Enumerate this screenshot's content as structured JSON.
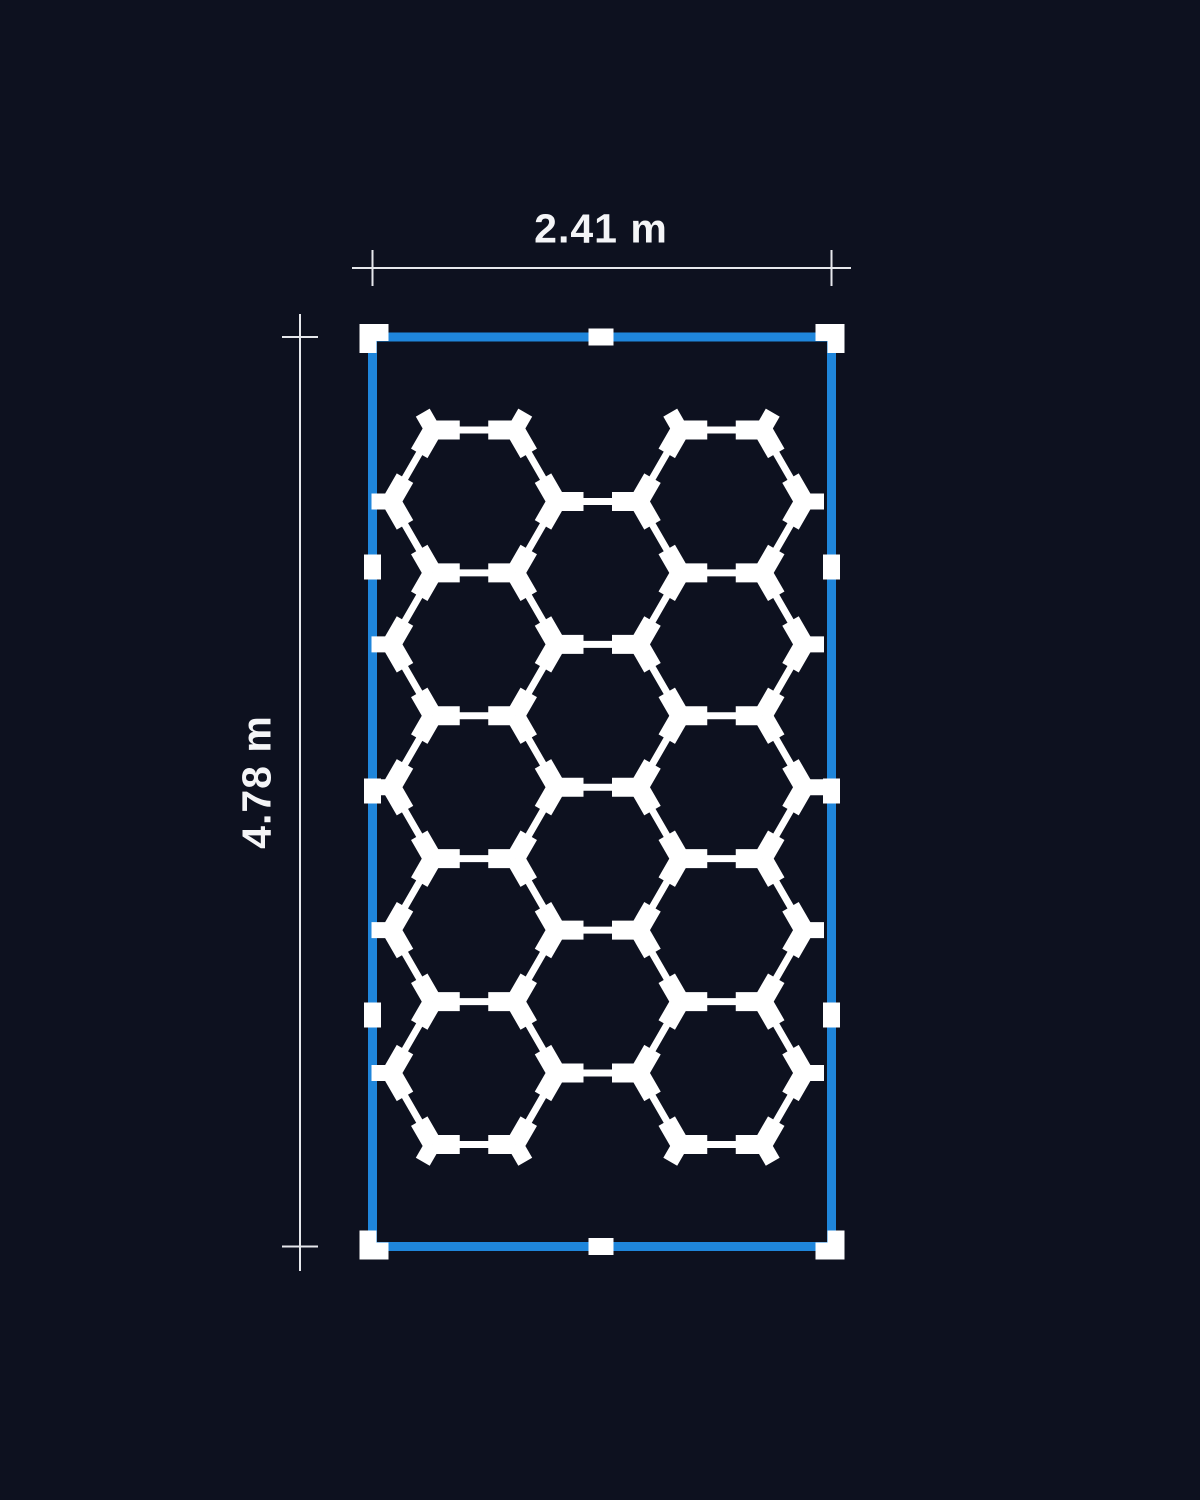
{
  "labels": {
    "width": "2.41 m",
    "height": "4.78 m"
  },
  "colors": {
    "background": "#0d111f",
    "frame_blue": "#1f86db",
    "grid_white": "#ffffff",
    "dimension_line": "#e6e8ec",
    "label_text": "#f4f5f7"
  },
  "diagram": {
    "frame": {
      "left": 372.5,
      "top": 337,
      "right": 831.5,
      "bottom": 1246.5,
      "stroke_width": 9,
      "mid_connector_x": 601,
      "side_connector_ys": [
        567,
        791,
        1015
      ],
      "corner_arm": 29,
      "corner_thickness": 17,
      "corner_overhang": 13,
      "mid_connector_long": 25,
      "mid_connector_thick": 17
    },
    "hex_grid": {
      "side": 82.5,
      "base_cy": 501.45,
      "columns": [
        {
          "cx": 474.0,
          "offset_rows": 0,
          "count": 5
        },
        {
          "cx": 597.75,
          "offset_rows": 0.5,
          "count": 4
        },
        {
          "cx": 721.5,
          "offset_rows": 0,
          "count": 5
        }
      ],
      "edge_width": 7,
      "connector_width": 19,
      "connector_length": 27,
      "tip_width": 16,
      "tip_length": 20
    },
    "dimension_top": {
      "y": 268,
      "line_x1": 352,
      "line_x2": 851,
      "tick_x1": 372.5,
      "tick_x2": 831.5,
      "tick_half": 18,
      "label_x": 601,
      "label_y": 229
    },
    "dimension_left": {
      "x": 300,
      "line_y1": 314,
      "line_y2": 1271,
      "tick_y1": 337,
      "tick_y2": 1246.5,
      "tick_half": 18,
      "label_x": 257,
      "label_y": 782
    }
  }
}
